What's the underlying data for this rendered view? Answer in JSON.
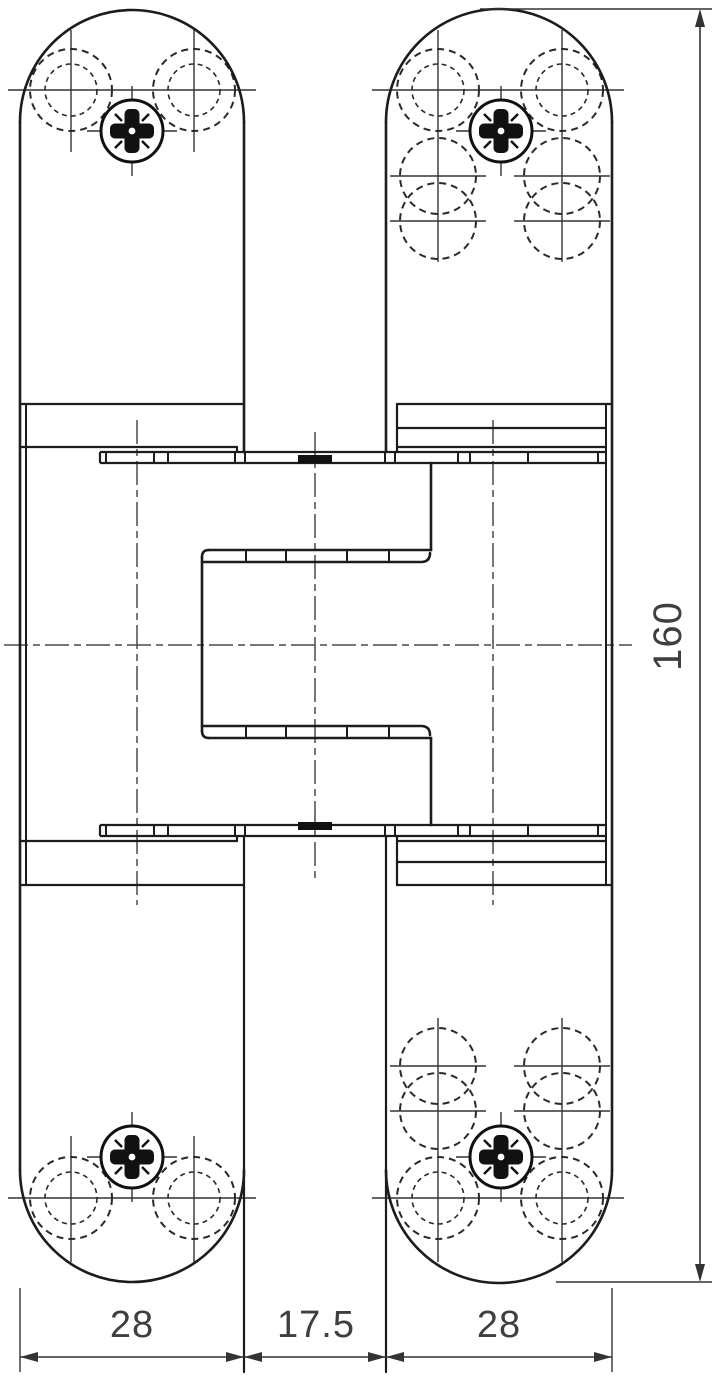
{
  "drawing": {
    "type": "technical-line-drawing",
    "subject": "concealed-hinge-front-elevation",
    "background": "#ffffff",
    "line_color": "#1c1c1c",
    "dim_text_color": "#3f3f3f",
    "dimensions": {
      "height_label": "160",
      "left_plate_width_label": "28",
      "gap_label": "17.5",
      "right_plate_width_label": "28"
    },
    "features": {
      "screws": "phillips-pozidriv-head",
      "hole_markings": "dashed-hidden-drill-holes",
      "center_part": "hinge-knuckle-section"
    }
  }
}
